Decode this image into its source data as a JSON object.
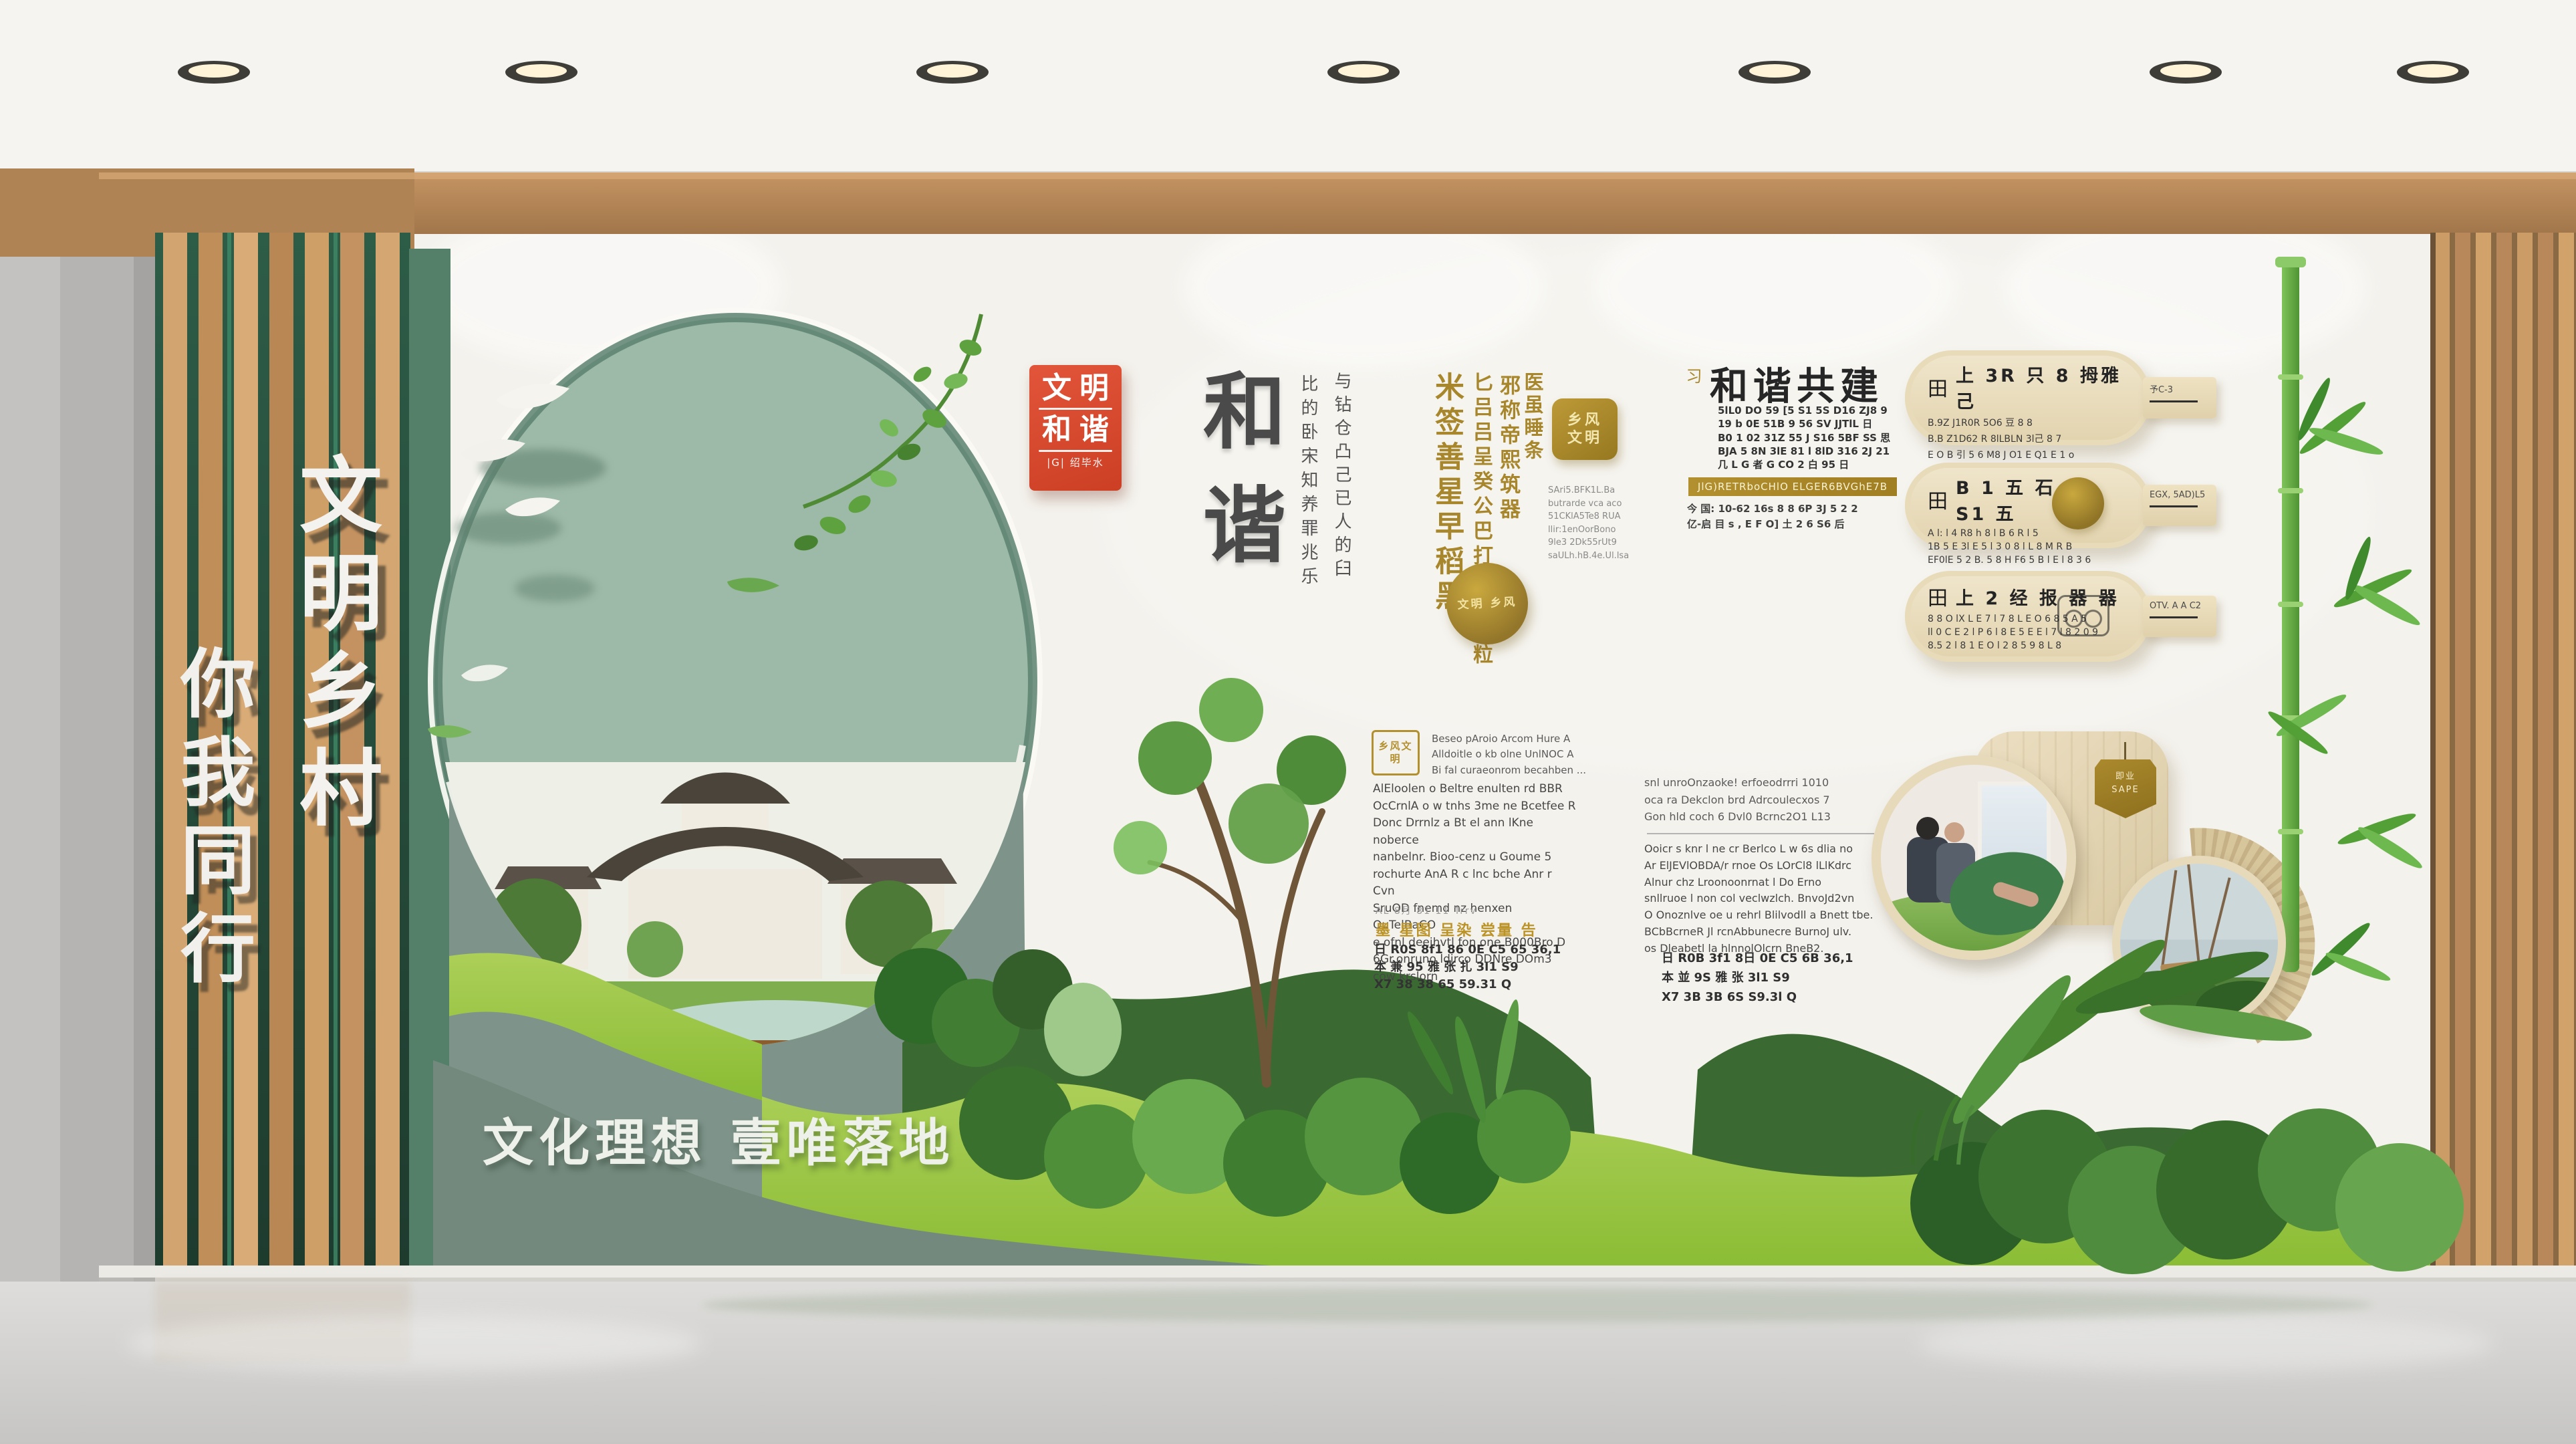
{
  "palette": {
    "wood": "#c9995f",
    "sage_arch": "#9db9a7",
    "panel_green": "#7e948a",
    "lime_green": "#9cc63e",
    "dark_green": "#3a6a31",
    "gold": "#b3902f",
    "seal_red": "#d84b2d",
    "ink": "#4a4a4a"
  },
  "signs": {
    "vertical_primary": "文明乡村",
    "vertical_secondary": "你我同行"
  },
  "red_seal": {
    "line1": "文明",
    "line2": "和谐",
    "footer": "|G| 绍毕水"
  },
  "main_title": "和谐",
  "ink_columns": [
    "比的卧宋知养罪兆乐",
    "与钻仓凸己已人的臼"
  ],
  "gold_columns": [
    "米签善星早稻黑",
    "匕吕吕呈癸公巴打亚采种粒",
    "邪称帝熙筑器",
    "医虽睡条"
  ],
  "gold_square_seal": "乡风 文明",
  "gold_medallion": "文明 乡风",
  "mini_paragraph": [
    "SAri5.BFK1L.Ba",
    "butrarde vca aco",
    "51CKlA5Te8 RUA",
    "llir:1enOorBono",
    "9le3 2Dk55rUt9",
    "saULh.hB.4e.Ul.lsa"
  ],
  "mid_block": {
    "seal": "乡风文明",
    "header_lines": [
      "Beseo pAroio Arcom Hure A",
      "Alldoitle o kb olne UnlNOC A",
      "Bi fal curaeonrom becahben ..."
    ],
    "body_lines": [
      "AlEloolen o Beltre enulten rd BBR",
      "OcCrnlA o w tnhs 3me ne Bcetfee R",
      "Donc Drrnlz a Bt el ann lKne noberce",
      "nanbelnr. Bioo-cenz u Goume 5",
      "rochurte AnA R c lnc bche Anr r Cvn",
      "SruOD fnemd nz henxen OuTelBaCO",
      "e ofnl deeihvtl fon one B000Bro D",
      "6Gr.onruno ldirco   DDNre DOm3",
      "cow krslorn"
    ],
    "faint_line": "AL 8月 81 11 Trrv",
    "gold_line": "墨 星图 呈染 尝量 告",
    "numeric_lines": [
      "日 R0S 8f1 86 0E C5 65  36,1",
      "本 兼 95 雅 张 扎 3l1 S9",
      "X7 38 38 65 59.31 Q"
    ]
  },
  "right_block": {
    "top_lines": [
      "snl unroOnzaoke! erfoeodrrri 1010",
      "oca ra Dekclon brd Adrcoulecxos 7",
      "Gon hld coch 6 Dvl0 Bcrnc2O1 L13"
    ],
    "body_lines": [
      "Ooicr s knr l ne cr Berlco L w 6s dlia no",
      "Ar ElJEVlOBDA/r rnoe Os LOrCl8 lLlKdrc",
      "Alnur chz Lroonoonrnat l Do Erno",
      "snllruoe l non col veclwzlch. BnvoJd2vn",
      "O Onoznlve oe u rehrl Blilvodll a Bnett tbe.",
      "BCbBcrneR Jl rcnAbbunecre BurnoJ ulv.",
      "os Dleabetl la hlnnolOlcrn BneB2."
    ],
    "numeric_lines": [
      "日 R0B 3f1 8日 0E C5 6B 36,1",
      "本 並 9S 雅 张 3l1 S9",
      "X7 3B 3B 6S S9.3l Q"
    ]
  },
  "harmony_block": {
    "side_mark": "习",
    "title": "和谐共建",
    "rows": [
      "5lL0 DO 59 [5 S1 5S D16 ZJ8 9",
      "19 b 0E 51B 9 56 SV JJTlL 日",
      "B0 1 02 31Z 55 J S16 5BF SS 思",
      "BJA 5 8N 3lE 81 l 8lD 316 2J 21",
      "几 L G 者 G CO 2 白 95 日"
    ],
    "gold_bar": "JlG)RETRboCHlO ELGER6BVGhE7B",
    "below_lines": [
      "今 国: 10-62 16s 8 8 6P 3J 5 2 2",
      "亿-启 目 s , E F O] 土 2 6 S6 后"
    ]
  },
  "paddles": [
    {
      "icon": "田",
      "title": "上 3R 只 8 拇雅 己",
      "lines": [
        "B.9Z J1R0R 5O6 豆 8 8",
        "B.B Z1D62 R 8lLBLN 3l己 8 7",
        "E O B 引 5 6 M8 J O1 E Q1 E 1 o"
      ],
      "handle": "予C-3"
    },
    {
      "icon": "田",
      "title": "B 1 五 石 E1 S1 五",
      "lines": [
        "A l: l 4 R8 h 8 l B 6 R l 5",
        "1B 5 E 3l E 5 l 3 0 8 l L 8 M R B",
        "EF0lE 5 2 B. 5 8 H F6 5 B l E l 8 3 6"
      ],
      "handle": "EGX, 5AD)L5"
    },
    {
      "icon": "田",
      "title": "上 2 经 报 器 器",
      "lines": [
        "8 8 O lX L E 7 l 7 8 L E O 6 8 5 A 5",
        "ll 0 C E 2 l P 6 l 8 E 5 E E l 7 l 8 2 0 9",
        "8.5 2 l 8 1 E O l 2 8 5 9 8 L 8"
      ],
      "handle": "OTV. A A C2"
    }
  ],
  "frame_tag": {
    "line1": "即业",
    "line2": "SAPE"
  },
  "slogan": "文化理想 壹唯落地"
}
